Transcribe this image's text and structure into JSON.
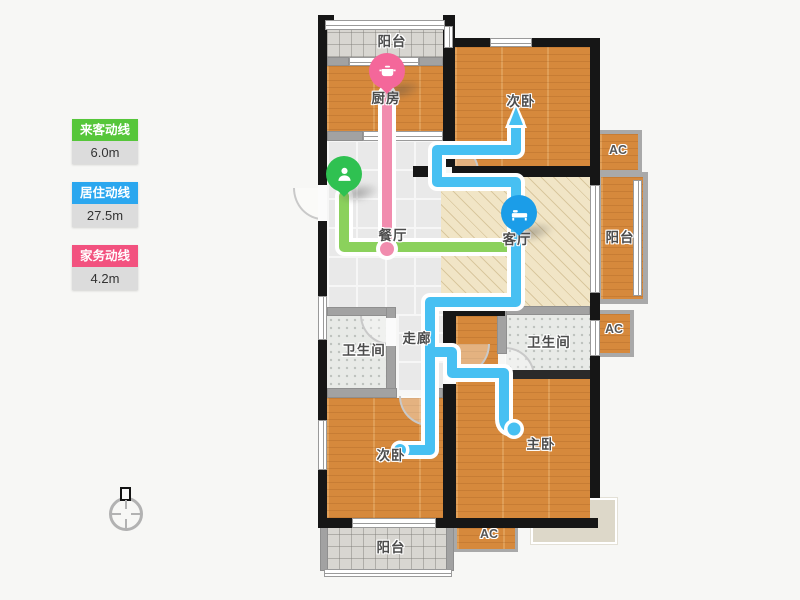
{
  "legend": {
    "items": [
      {
        "label": "来客动线",
        "value": "6.0m",
        "color": "#56c63a"
      },
      {
        "label": "居住动线",
        "value": "27.5m",
        "color": "#2ba7ef"
      },
      {
        "label": "家务动线",
        "value": "4.2m",
        "color": "#f2527f"
      }
    ]
  },
  "floorplan": {
    "rooms": {
      "balcony_top": "阳台",
      "kitchen": "厨房",
      "bedroom_top": "次卧",
      "ac_top": "AC",
      "balcony_right": "阳台",
      "ac_mid": "AC",
      "dining": "餐厅",
      "living": "客厅",
      "corridor": "走廊",
      "bath_left": "卫生间",
      "bath_right": "卫生间",
      "bedroom_bottom": "次卧",
      "master": "主卧",
      "ac_bottom": "AC",
      "balcony_bottom": "阳台"
    },
    "lines": {
      "visitor": {
        "name": "来客动线",
        "length": "6.0m",
        "color": "#8bd15c"
      },
      "resident": {
        "name": "居住动线",
        "length": "27.5m",
        "color": "#47c0f2"
      },
      "chores": {
        "name": "家务动线",
        "length": "4.2m",
        "color": "#f18cae"
      }
    },
    "pins": {
      "entry": {
        "icon": "person-pin-icon",
        "color": "#2fc151"
      },
      "kitchen": {
        "icon": "pot-pin-icon",
        "color": "#f4679a"
      },
      "living": {
        "icon": "bed-pin-icon",
        "color": "#1b9de8"
      }
    }
  }
}
